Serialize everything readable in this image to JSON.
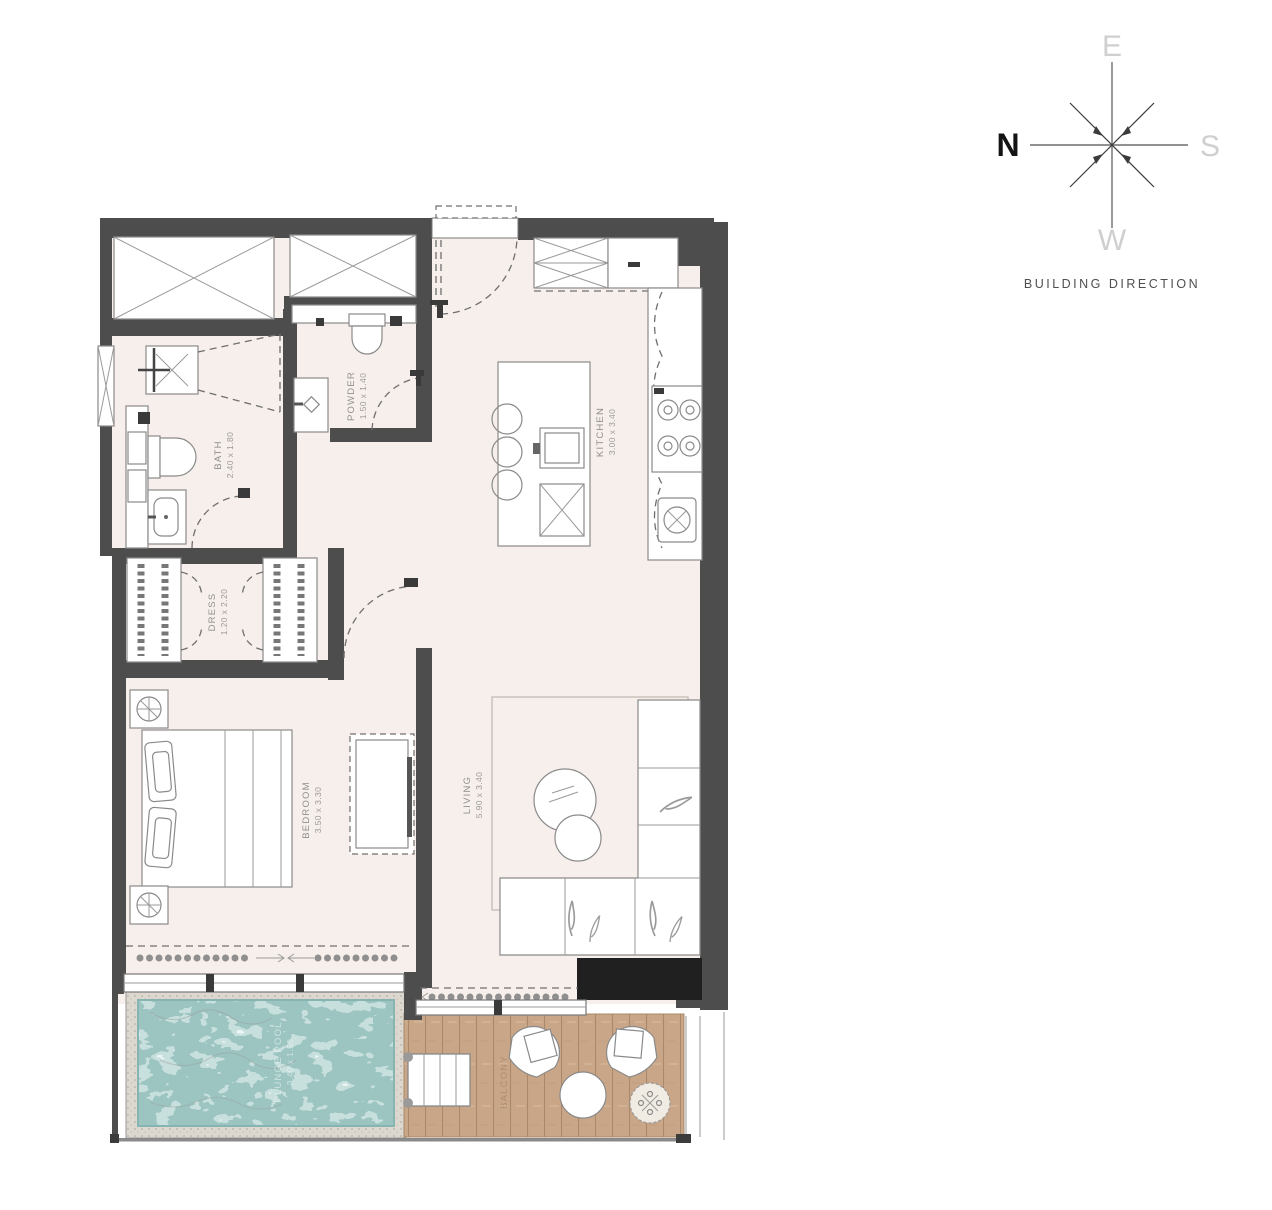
{
  "compass": {
    "north": "N",
    "east": "E",
    "south": "S",
    "west": "W",
    "caption": "BUILDING DIRECTION"
  },
  "rooms": {
    "bath": {
      "name": "BATH",
      "dims": "2.40 x 1.80"
    },
    "powder": {
      "name": "POWDER",
      "dims": "1.50 x 1.40"
    },
    "kitchen": {
      "name": "KITCHEN",
      "dims": "3.00 x 3.40"
    },
    "dress": {
      "name": "DRESS",
      "dims": "1.20 x 2.20"
    },
    "bedroom": {
      "name": "BEDROOM",
      "dims": "3.50 x 3.30"
    },
    "living": {
      "name": "LIVING",
      "dims": "5.90 x 3.40"
    },
    "plunge_pool": {
      "name": "PLUNGE POOL",
      "dims": "3.40 x 1.50"
    },
    "balcony": {
      "name": "BALCONY",
      "dims": ""
    }
  },
  "colors": {
    "wall": "#4d4d4d",
    "floor": "#f7efeb",
    "pool_water": "#9cc5c1",
    "deck_wood": "#c9a687",
    "label": "#8f8f8f",
    "accent_dark": "#202020"
  }
}
